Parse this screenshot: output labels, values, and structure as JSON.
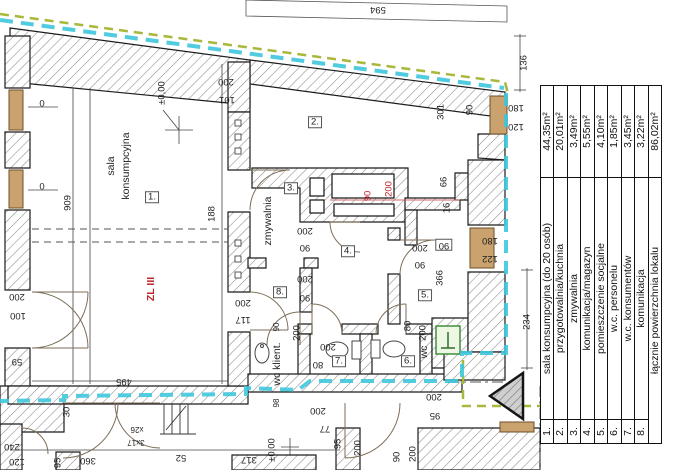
{
  "legend": {
    "rows": [
      {
        "no": "1.",
        "name": "sala konsumpcyjna (do 20 osób)",
        "area": "44,35m²"
      },
      {
        "no": "2.",
        "name": "przygotowalnia/kuchnia",
        "area": "20,01m²"
      },
      {
        "no": "3.",
        "name": "zmywalnia",
        "area": "3,49m²"
      },
      {
        "no": "4.",
        "name": "komunikacja/magazyn",
        "area": "5,55m²"
      },
      {
        "no": "5.",
        "name": "pomieszczenie socjalne",
        "area": "4,10m²"
      },
      {
        "no": "6.",
        "name": "w.c. personelu",
        "area": "1,85m²"
      },
      {
        "no": "7.",
        "name": "w.c. konsumentów",
        "area": "3,45m²"
      },
      {
        "no": "8.",
        "name": "komunikacja",
        "area": "3,22m²"
      },
      {
        "no": "",
        "name": "łącznie powierzchnia lokalu",
        "area": "86,02m²"
      }
    ]
  },
  "colors": {
    "boundary_cyan": "#3fc6dc",
    "boundary_olive": "#a9b73a",
    "red_accent": "#c0272d",
    "window_tan": "#c9a26d",
    "panel_green": "#3f8f3f"
  },
  "plan": {
    "labels": [
      {
        "t": "594",
        "x": 378,
        "y": 9,
        "r": 180,
        "c": ""
      },
      {
        "t": "200",
        "x": 226,
        "y": 81,
        "r": 180,
        "c": ""
      },
      {
        "t": "101",
        "x": 227,
        "y": 99,
        "r": 180,
        "c": ""
      },
      {
        "t": "136",
        "x": 524,
        "y": 63,
        "r": -90,
        "c": ""
      },
      {
        "t": "180",
        "x": 516,
        "y": 107,
        "r": 180,
        "c": ""
      },
      {
        "t": "120",
        "x": 516,
        "y": 126,
        "r": 180,
        "c": ""
      },
      {
        "t": "301",
        "x": 441,
        "y": 112,
        "r": -90,
        "c": ""
      },
      {
        "t": "90",
        "x": 470,
        "y": 110,
        "r": -90,
        "c": ""
      },
      {
        "t": "909",
        "x": 68,
        "y": 203,
        "r": -90,
        "c": ""
      },
      {
        "t": "0",
        "x": 42,
        "y": 104,
        "r": 0,
        "c": ""
      },
      {
        "t": "0",
        "x": 42,
        "y": 187,
        "r": 0,
        "c": ""
      },
      {
        "t": "188",
        "x": 212,
        "y": 214,
        "r": -90,
        "c": ""
      },
      {
        "t": "±0,00",
        "x": 162,
        "y": 93,
        "r": -90,
        "c": ""
      },
      {
        "t": "sala",
        "x": 111,
        "y": 166,
        "r": -90,
        "c": "room"
      },
      {
        "t": "konsumpcyjna",
        "x": 126,
        "y": 166,
        "r": -90,
        "c": "room"
      },
      {
        "t": "1.",
        "x": 152,
        "y": 197,
        "r": 0,
        "c": "roomnum"
      },
      {
        "t": "2.",
        "x": 315,
        "y": 122,
        "r": 0,
        "c": "roomnum"
      },
      {
        "t": "zmywalnia",
        "x": 268,
        "y": 221,
        "r": -90,
        "c": "room"
      },
      {
        "t": "3.",
        "x": 291,
        "y": 188,
        "r": 0,
        "c": "roomnum"
      },
      {
        "t": "66",
        "x": 444,
        "y": 182,
        "r": -90,
        "c": ""
      },
      {
        "t": "16",
        "x": 447,
        "y": 208,
        "r": -90,
        "c": ""
      },
      {
        "t": "90",
        "x": 368,
        "y": 196,
        "r": -90,
        "c": "red"
      },
      {
        "t": "200",
        "x": 389,
        "y": 189,
        "r": -90,
        "c": "red"
      },
      {
        "t": "200",
        "x": 305,
        "y": 230,
        "r": 180,
        "c": ""
      },
      {
        "t": "90",
        "x": 305,
        "y": 247,
        "r": 180,
        "c": ""
      },
      {
        "t": "4.",
        "x": 348,
        "y": 251,
        "r": 0,
        "c": "roomnum"
      },
      {
        "t": "200",
        "x": 420,
        "y": 247,
        "r": 180,
        "c": ""
      },
      {
        "t": "90",
        "x": 420,
        "y": 264,
        "r": 180,
        "c": ""
      },
      {
        "t": "90",
        "x": 444,
        "y": 245,
        "r": 180,
        "c": "roomnum"
      },
      {
        "t": "180",
        "x": 490,
        "y": 240,
        "r": 180,
        "c": ""
      },
      {
        "t": "122",
        "x": 490,
        "y": 258,
        "r": 180,
        "c": ""
      },
      {
        "t": "366",
        "x": 440,
        "y": 278,
        "r": -90,
        "c": ""
      },
      {
        "t": "234",
        "x": 527,
        "y": 322,
        "r": -90,
        "c": ""
      },
      {
        "t": "5.",
        "x": 425,
        "y": 295,
        "r": 0,
        "c": "roomnum"
      },
      {
        "t": "200",
        "x": 305,
        "y": 278,
        "r": 180,
        "c": ""
      },
      {
        "t": "90",
        "x": 305,
        "y": 297,
        "r": 180,
        "c": ""
      },
      {
        "t": "8.",
        "x": 280,
        "y": 292,
        "r": 0,
        "c": "roomnum"
      },
      {
        "t": "200",
        "x": 243,
        "y": 302,
        "r": 180,
        "c": ""
      },
      {
        "t": "117",
        "x": 243,
        "y": 319,
        "r": 180,
        "c": ""
      },
      {
        "t": "ZL III",
        "x": 151,
        "y": 289,
        "r": -90,
        "c": "room red bold"
      },
      {
        "t": "200",
        "x": 17,
        "y": 296,
        "r": 180,
        "c": ""
      },
      {
        "t": "100",
        "x": 18,
        "y": 315,
        "r": 180,
        "c": ""
      },
      {
        "t": "59",
        "x": 17,
        "y": 361,
        "r": 180,
        "c": ""
      },
      {
        "t": "495",
        "x": 124,
        "y": 381,
        "r": 180,
        "c": ""
      },
      {
        "t": "200",
        "x": 297,
        "y": 333,
        "r": -90,
        "c": ""
      },
      {
        "t": "90",
        "x": 277,
        "y": 327,
        "r": -90,
        "c": "small"
      },
      {
        "t": "wc klient.",
        "x": 277,
        "y": 364,
        "r": -90,
        "c": "room"
      },
      {
        "t": "98",
        "x": 277,
        "y": 403,
        "r": -90,
        "c": "small"
      },
      {
        "t": "200",
        "x": 328,
        "y": 346,
        "r": 180,
        "c": ""
      },
      {
        "t": "80",
        "x": 318,
        "y": 364,
        "r": 180,
        "c": ""
      },
      {
        "t": "7.",
        "x": 339,
        "y": 361,
        "r": 0,
        "c": "roomnum"
      },
      {
        "t": "6.",
        "x": 408,
        "y": 361,
        "r": 0,
        "c": "roomnum"
      },
      {
        "t": "wc",
        "x": 424,
        "y": 352,
        "r": -90,
        "c": "room"
      },
      {
        "t": "80",
        "x": 408,
        "y": 326,
        "r": -90,
        "c": ""
      },
      {
        "t": "200",
        "x": 423,
        "y": 333,
        "r": -90,
        "c": ""
      },
      {
        "t": "30",
        "x": 67,
        "y": 412,
        "r": -90,
        "c": ""
      },
      {
        "t": "240",
        "x": 12,
        "y": 446,
        "r": 180,
        "c": ""
      },
      {
        "t": "120",
        "x": 17,
        "y": 461,
        "r": 180,
        "c": ""
      },
      {
        "t": "95",
        "x": 58,
        "y": 463,
        "r": -90,
        "c": ""
      },
      {
        "t": "360",
        "x": 88,
        "y": 460,
        "r": 180,
        "c": ""
      },
      {
        "t": "52",
        "x": 181,
        "y": 457,
        "r": 180,
        "c": ""
      },
      {
        "t": "3x17",
        "x": 136,
        "y": 442,
        "r": 180,
        "c": "small"
      },
      {
        "t": "x26",
        "x": 137,
        "y": 429,
        "r": 180,
        "c": "small"
      },
      {
        "t": "317",
        "x": 249,
        "y": 459,
        "r": 180,
        "c": ""
      },
      {
        "t": "±0,00",
        "x": 272,
        "y": 450,
        "r": -90,
        "c": ""
      },
      {
        "t": "77",
        "x": 325,
        "y": 428,
        "r": 180,
        "c": ""
      },
      {
        "t": "95",
        "x": 338,
        "y": 444,
        "r": -90,
        "c": ""
      },
      {
        "t": "200",
        "x": 358,
        "y": 448,
        "r": -90,
        "c": ""
      },
      {
        "t": "90",
        "x": 397,
        "y": 457,
        "r": -90,
        "c": ""
      },
      {
        "t": "200",
        "x": 413,
        "y": 454,
        "r": -90,
        "c": ""
      },
      {
        "t": "200",
        "x": 434,
        "y": 396,
        "r": 180,
        "c": ""
      },
      {
        "t": "95",
        "x": 435,
        "y": 415,
        "r": 180,
        "c": ""
      },
      {
        "t": "200",
        "x": 318,
        "y": 410,
        "r": 180,
        "c": ""
      }
    ]
  }
}
